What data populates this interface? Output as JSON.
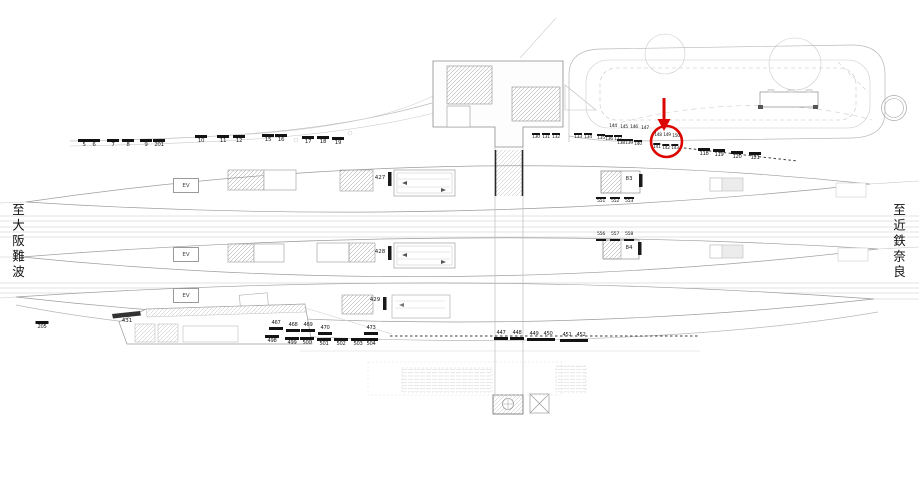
{
  "destinations": {
    "left": "至大阪難波",
    "right": "至近鉄奈良"
  },
  "ev_label": "EV",
  "colors": {
    "highlight": "#dd0500",
    "marker": "#131313",
    "line_light": "#c3c3c3"
  },
  "static_labels": [
    {
      "t": "427",
      "x": 380,
      "y": 176,
      "fs": 5.5
    },
    {
      "t": "428",
      "x": 380,
      "y": 250,
      "fs": 5.5
    },
    {
      "t": "429",
      "x": 375,
      "y": 298,
      "fs": 5.5
    },
    {
      "t": "83",
      "x": 629,
      "y": 177,
      "fs": 5.5
    },
    {
      "t": "84",
      "x": 629,
      "y": 246,
      "fs": 5.5
    },
    {
      "t": "431",
      "x": 127,
      "y": 319,
      "fs": 5.5
    }
  ],
  "ev_boxes": [
    {
      "x": 173,
      "y": 178
    },
    {
      "x": 173,
      "y": 247
    },
    {
      "x": 173,
      "y": 288
    }
  ],
  "tick_groups": [
    {
      "name": "west-markers",
      "bar": "above",
      "fs": 5.5,
      "bw": 12,
      "items": [
        {
          "t": "5",
          "x": 84,
          "y": 138
        },
        {
          "t": "6",
          "x": 94,
          "y": 138
        },
        {
          "t": "7",
          "x": 113,
          "y": 138
        },
        {
          "t": "8",
          "x": 128,
          "y": 138
        },
        {
          "t": "9",
          "x": 146,
          "y": 138
        },
        {
          "t": "201",
          "x": 159,
          "y": 138
        },
        {
          "t": "10",
          "x": 201,
          "y": 134
        },
        {
          "t": "11",
          "x": 223,
          "y": 134
        },
        {
          "t": "12",
          "x": 239,
          "y": 134
        },
        {
          "t": "15",
          "x": 268,
          "y": 133
        },
        {
          "t": "16",
          "x": 281,
          "y": 133
        },
        {
          "t": "17",
          "x": 308,
          "y": 135
        },
        {
          "t": "18",
          "x": 323,
          "y": 135
        },
        {
          "t": "19",
          "x": 338,
          "y": 136
        }
      ]
    },
    {
      "name": "markers-130",
      "bar": "above",
      "fs": 4.6,
      "bw": 8,
      "items": [
        {
          "t": "130",
          "x": 536,
          "y": 132
        },
        {
          "t": "131",
          "x": 546,
          "y": 132
        },
        {
          "t": "132",
          "x": 556,
          "y": 132
        },
        {
          "t": "133",
          "x": 578,
          "y": 132
        },
        {
          "t": "134",
          "x": 588,
          "y": 132
        }
      ]
    },
    {
      "name": "markers-144",
      "bar": "none",
      "fs": 4.6,
      "bw": 8,
      "items": [
        {
          "t": "144",
          "x": 613,
          "y": 125
        },
        {
          "t": "145",
          "x": 624,
          "y": 126
        },
        {
          "t": "146",
          "x": 634,
          "y": 126
        },
        {
          "t": "147",
          "x": 645,
          "y": 127
        }
      ]
    },
    {
      "name": "markers-135",
      "bar": "above",
      "fs": 4.6,
      "bw": 8,
      "items": [
        {
          "t": "135",
          "x": 601,
          "y": 133
        },
        {
          "t": "136",
          "x": 609,
          "y": 134
        },
        {
          "t": "137",
          "x": 618,
          "y": 134
        }
      ]
    },
    {
      "name": "markers-138",
      "bar": "above",
      "fs": 4.6,
      "bw": 8,
      "items": [
        {
          "t": "138",
          "x": 621,
          "y": 138
        },
        {
          "t": "139",
          "x": 629,
          "y": 138
        },
        {
          "t": "140",
          "x": 638,
          "y": 139
        }
      ]
    },
    {
      "name": "markers-circled-top",
      "bar": "none",
      "fs": 4.4,
      "bw": 7,
      "items": [
        {
          "t": "148",
          "x": 658,
          "y": 134
        },
        {
          "t": "149",
          "x": 667,
          "y": 134
        },
        {
          "t": "150",
          "x": 676,
          "y": 135
        }
      ]
    },
    {
      "name": "markers-circled-bottom",
      "bar": "above",
      "fs": 4.4,
      "bw": 7,
      "items": [
        {
          "t": "141",
          "x": 657,
          "y": 142
        },
        {
          "t": "142",
          "x": 666,
          "y": 143
        },
        {
          "t": "143",
          "x": 675,
          "y": 143
        }
      ]
    },
    {
      "name": "markers-118",
      "bar": "above",
      "fs": 5.2,
      "bw": 12,
      "items": [
        {
          "t": "118",
          "x": 704,
          "y": 147
        },
        {
          "t": "119",
          "x": 719,
          "y": 148
        },
        {
          "t": "120",
          "x": 737,
          "y": 150
        },
        {
          "t": "121",
          "x": 755,
          "y": 151
        }
      ]
    },
    {
      "name": "markers-551",
      "bar": "above",
      "fs": 4.7,
      "bw": 10,
      "items": [
        {
          "t": "551",
          "x": 601,
          "y": 196
        },
        {
          "t": "552",
          "x": 615,
          "y": 196
        },
        {
          "t": "553",
          "x": 629,
          "y": 196
        }
      ]
    },
    {
      "name": "markers-556",
      "bar": "below",
      "fs": 4.7,
      "bw": 10,
      "items": [
        {
          "t": "556",
          "x": 601,
          "y": 233
        },
        {
          "t": "557",
          "x": 615,
          "y": 233
        },
        {
          "t": "558",
          "x": 629,
          "y": 233
        }
      ]
    },
    {
      "name": "marker-205",
      "bar": "above",
      "fs": 5.2,
      "bw": 13,
      "items": [
        {
          "t": "205",
          "x": 42,
          "y": 320
        }
      ]
    },
    {
      "name": "markers-467",
      "bar": "below",
      "fs": 5.2,
      "bw": 14,
      "items": [
        {
          "t": "467",
          "x": 276,
          "y": 321
        },
        {
          "t": "468",
          "x": 293,
          "y": 323
        },
        {
          "t": "469",
          "x": 308,
          "y": 323
        },
        {
          "t": "470",
          "x": 325,
          "y": 326
        },
        {
          "t": "473",
          "x": 371,
          "y": 326
        }
      ]
    },
    {
      "name": "markers-498",
      "bar": "above",
      "fs": 5.2,
      "bw": 14,
      "items": [
        {
          "t": "498",
          "x": 272,
          "y": 334
        },
        {
          "t": "499",
          "x": 292,
          "y": 336
        },
        {
          "t": "500",
          "x": 307,
          "y": 336
        },
        {
          "t": "501",
          "x": 324,
          "y": 337
        },
        {
          "t": "502",
          "x": 341,
          "y": 337
        },
        {
          "t": "503",
          "x": 358,
          "y": 337
        },
        {
          "t": "504",
          "x": 371,
          "y": 337
        }
      ]
    },
    {
      "name": "markers-447",
      "bar": "below",
      "fs": 5.2,
      "bw": 14,
      "items": [
        {
          "t": "447",
          "x": 501,
          "y": 331
        },
        {
          "t": "448",
          "x": 517,
          "y": 331
        },
        {
          "t": "449",
          "x": 534,
          "y": 332
        },
        {
          "t": "450",
          "x": 548,
          "y": 332
        },
        {
          "t": "451",
          "x": 567,
          "y": 333
        },
        {
          "t": "452",
          "x": 581,
          "y": 333
        }
      ]
    }
  ]
}
